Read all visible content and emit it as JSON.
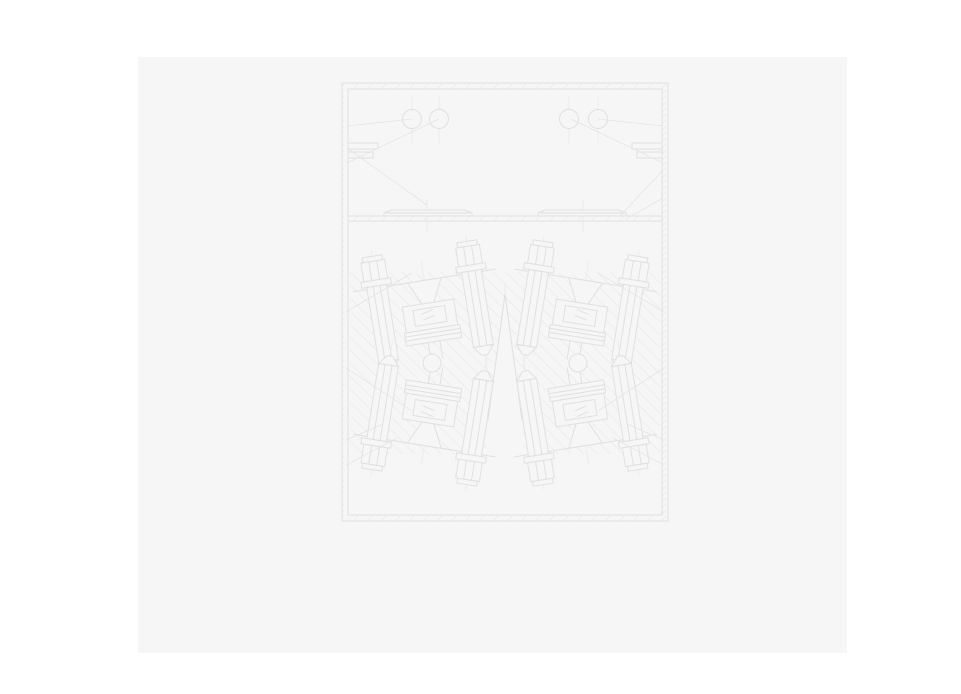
{
  "colors": {
    "page-bg": "#ffffff",
    "panel-bg": "#f6f6f6",
    "line": "#e0e0e0",
    "faint": "#eaeaea",
    "hatch": "#ececec"
  },
  "drawing": {
    "kind": "engineering-section-drawing",
    "text_labels": [],
    "components": [
      "outer-frame",
      "hopper-section",
      "bore-hole-circles",
      "flange-brackets",
      "slide-rail",
      "slide-plates",
      "bolt-assembly-units",
      "hex-bolts",
      "inspection-windows",
      "pivot-circles",
      "section-hatching",
      "leader-lines"
    ],
    "bore_circle_count": 4,
    "pivot_circle_count": 2,
    "bolt_unit_count": 4
  }
}
